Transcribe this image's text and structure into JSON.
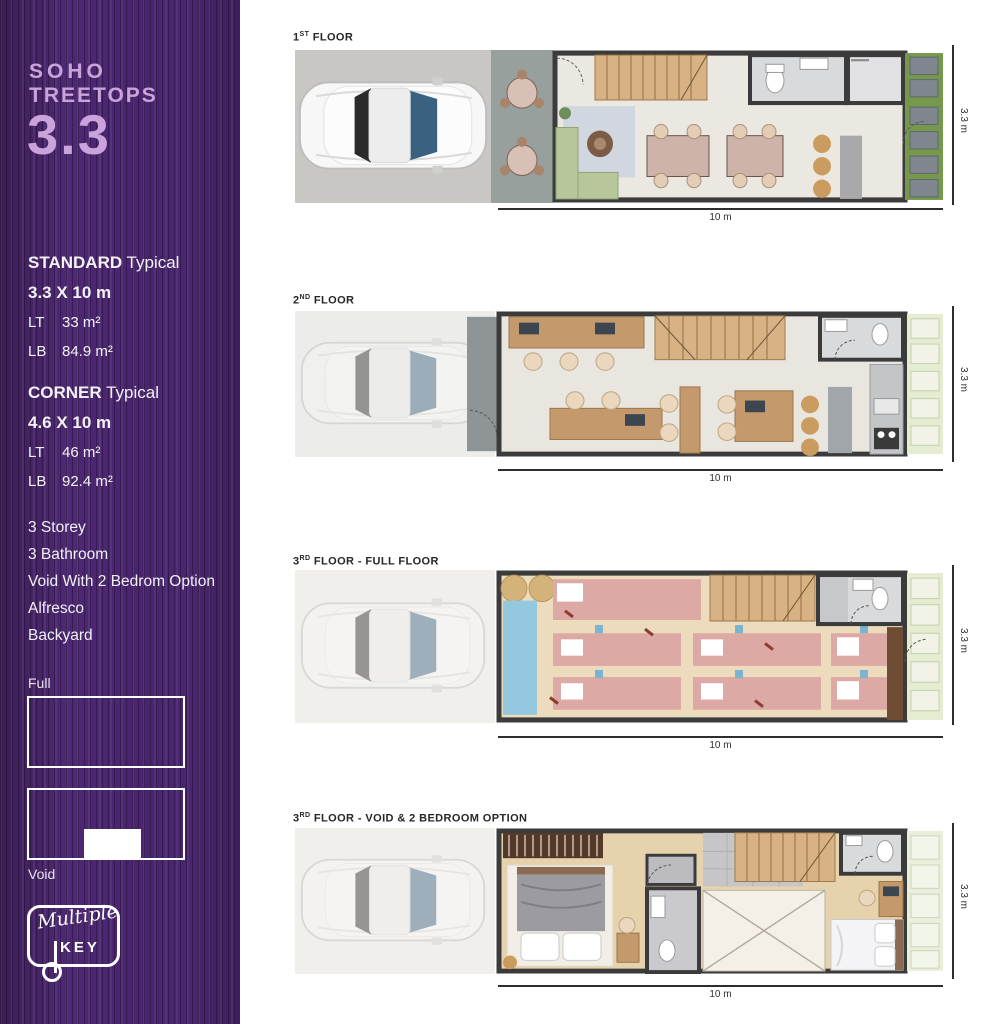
{
  "colors": {
    "brand_purple": "#482469",
    "brand_lavender": "#c9a3da",
    "wall": "#3b3b3b",
    "grass_green": "#76984b",
    "mat_pink": "#dca9a4",
    "stair_wood": "#d8b184"
  },
  "sidebar": {
    "logo_line1": "SOHO",
    "logo_line2": "TREETOPS",
    "unit_number": "3.3",
    "standard": {
      "title_bold": "STANDARD",
      "title_rest": " Typical",
      "dimension": "3.3 X 10 m",
      "lt_label": "LT",
      "lt_value": "33 m²",
      "lb_label": "LB",
      "lb_value": "84.9 m²"
    },
    "corner": {
      "title_bold": "CORNER",
      "title_rest": " Typical",
      "dimension": "4.6 X 10 m",
      "lt_label": "LT",
      "lt_value": "46 m²",
      "lb_label": "LB",
      "lb_value": "92.4 m²"
    },
    "features": [
      "3 Storey",
      "3 Bathroom",
      "Void With 2 Bedrom Option",
      "Alfresco",
      "Backyard"
    ],
    "full_label": "Full",
    "void_label": "Void",
    "brand_script": "Multiple",
    "brand_key": "KEY"
  },
  "plans": [
    {
      "floor_num": "1",
      "floor_sup": "ST",
      "floor_rest": " FLOOR",
      "width_dim": "10 m",
      "height_dim": "3.3 m"
    },
    {
      "floor_num": "2",
      "floor_sup": "ND",
      "floor_rest": " FLOOR",
      "width_dim": "10 m",
      "height_dim": "3.3 m"
    },
    {
      "floor_num": "3",
      "floor_sup": "RD",
      "floor_rest": " FLOOR - FULL FLOOR",
      "width_dim": "10 m",
      "height_dim": "3.3 m"
    },
    {
      "floor_num": "3",
      "floor_sup": "RD",
      "floor_rest": " FLOOR - VOID & 2 BEDROOM OPTION",
      "width_dim": "10 m",
      "height_dim": "3.3 m"
    }
  ]
}
